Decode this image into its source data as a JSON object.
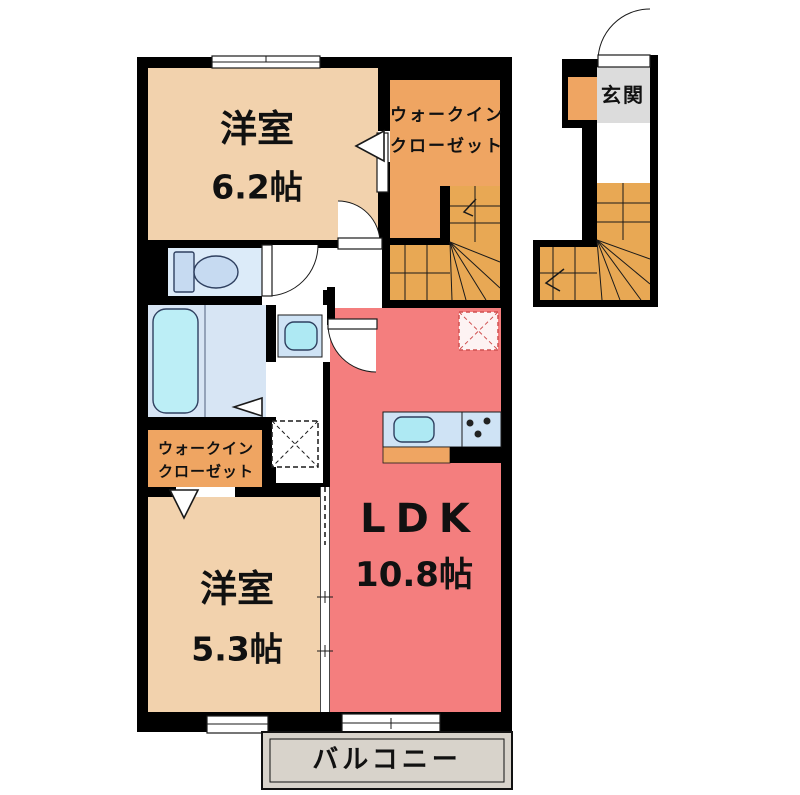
{
  "plan": {
    "bedroom1": {
      "name": "洋室",
      "size": "6.2帖"
    },
    "wic1": {
      "line1": "ウォークイン",
      "line2": "クローゼット"
    },
    "genkan": {
      "name": "玄関"
    },
    "ldk": {
      "name": "LDK",
      "size": "10.8帖"
    },
    "bedroom2": {
      "name": "洋室",
      "size": "5.3帖"
    },
    "wic2": {
      "line1": "ウォークイン",
      "line2": "クローゼット"
    },
    "balcony": {
      "name": "バルコニー"
    }
  },
  "colors": {
    "wall": "#000000",
    "bedroom_floor": "#f2d2ad",
    "closet_floor": "#efa562",
    "stairs_floor": "#e8a854",
    "ldk_floor": "#f47e7e",
    "toilet_floor": "#dcebf9",
    "bath_floor": "#d7e5f4",
    "fixture_blue": "#c6daf1",
    "fixture_light": "#cfe3f5",
    "fixture_cyan": "#aee9f3",
    "bathtub": "#bceef6",
    "balcony_floor": "#d8d3cb",
    "genkan_floor": "#dcdcdc",
    "fridge_dash": "#d05050",
    "text": "#111111"
  }
}
